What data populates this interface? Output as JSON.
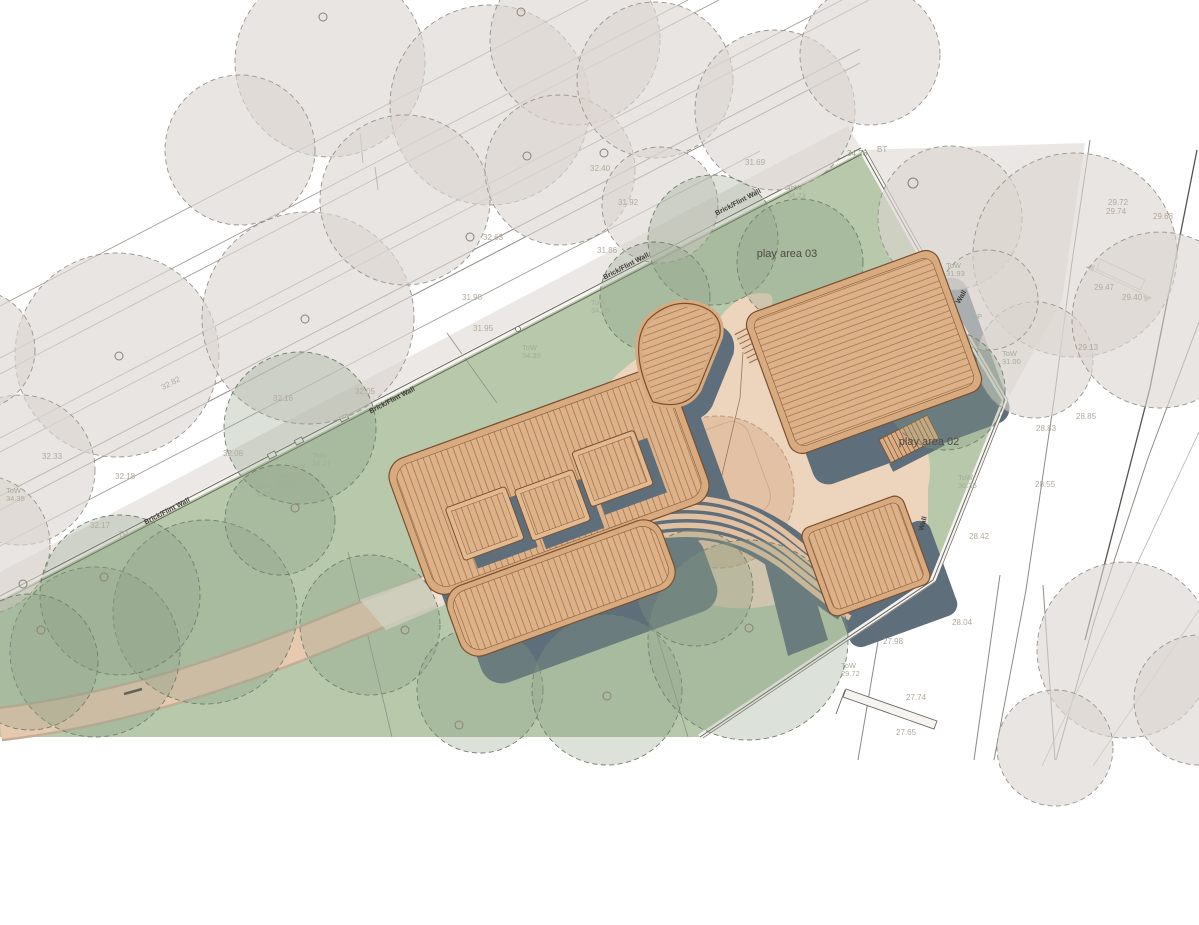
{
  "drawing": {
    "title": "Nursery site plan",
    "play_area_03": "play area 03",
    "play_area_02": "play area 02",
    "brick_flint_wall": "Brick/Flint Wall",
    "wall": "Wall",
    "tow": "ToW",
    "tp": "TP",
    "lp": "LP",
    "bt": "BT"
  },
  "tow_values": [
    "34.39",
    "34.25",
    "34.23",
    "31.93",
    "31.00",
    "30.36",
    "29.72",
    "34.27",
    "35.08",
    "35.43",
    "34.26",
    "34.35"
  ],
  "spot_levels": [
    "32.82",
    "32.16",
    "32.33",
    "32.18",
    "32.08",
    "32.17",
    "32.05",
    "32.63",
    "32.40",
    "31.92",
    "31.86",
    "31.98",
    "31.95",
    "31.69",
    "34.36",
    "29.72",
    "29.74",
    "29.68",
    "29.47",
    "29.40",
    "29.13",
    "28.85",
    "28.83",
    "28.55",
    "28.42",
    "28.04",
    "27.98",
    "27.74",
    "27.65"
  ],
  "palette": {
    "site_green": "#b7c8ab",
    "canopy_grey": "#dbd5d0",
    "canopy_green": "#8ba083",
    "sand": "#ecd4bd",
    "sand_circle": "#e3c1a5",
    "deck_wood": "#d7aa80",
    "plank_line": "#a5774a",
    "shadow_slate": "#5e6e7b",
    "pavement": "#ebe8e5",
    "wall_line": "#6b665f",
    "spot_text": "#b3a99d",
    "tow_text": "#a3ae97"
  }
}
